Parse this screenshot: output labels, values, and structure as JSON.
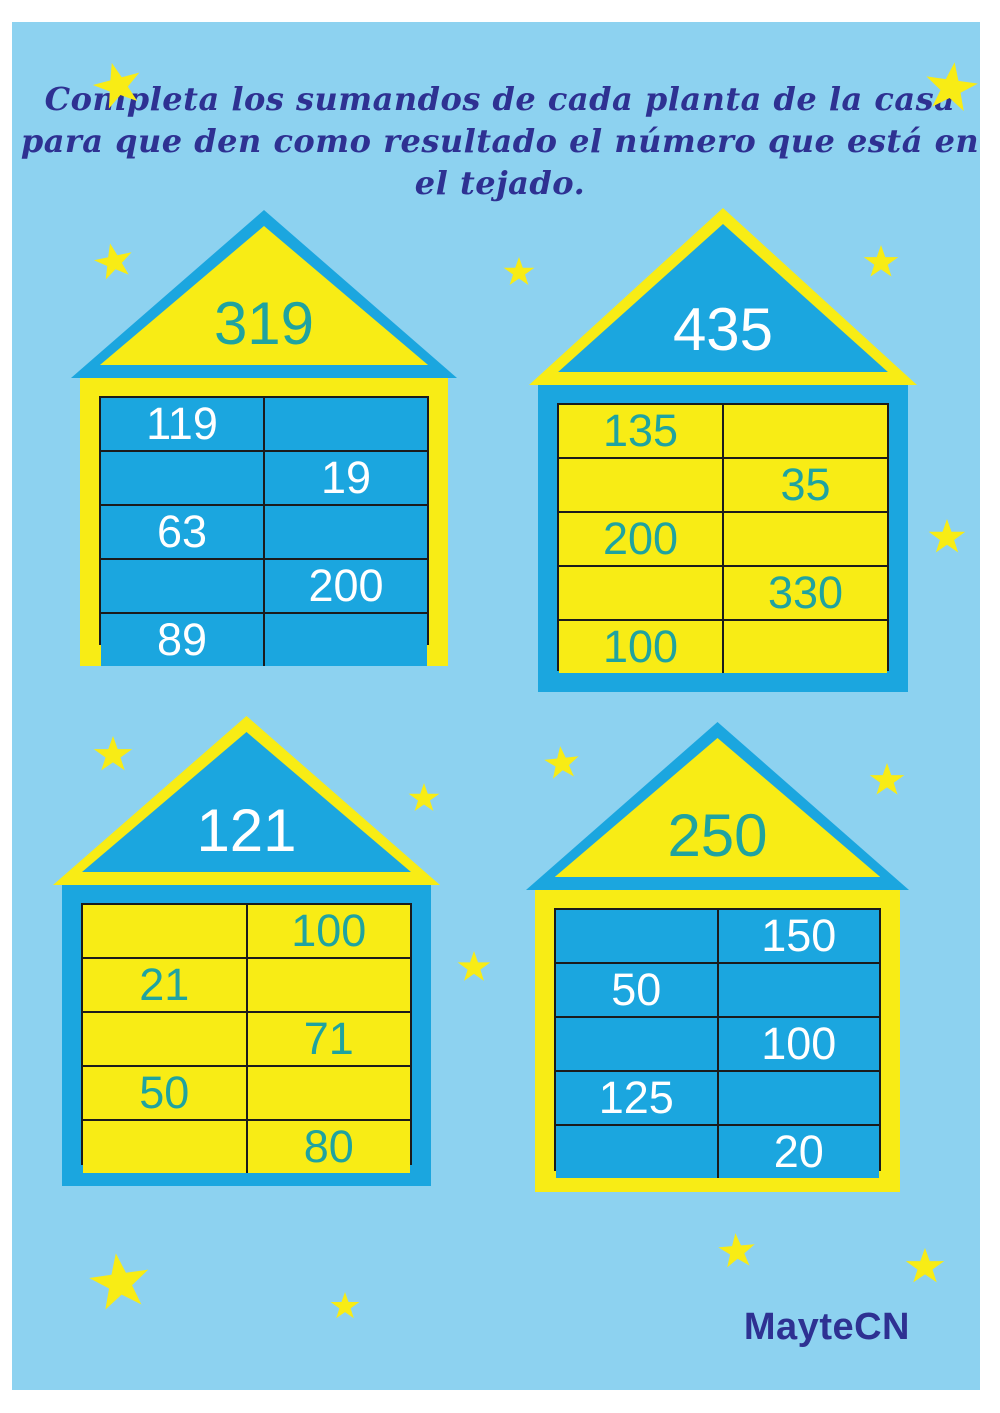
{
  "title": {
    "line1": "Completa los sumandos de cada planta de la casa",
    "line2": "para que den como resultado el número que está en el tejado."
  },
  "credit": "MayteCN",
  "colors": {
    "page_bg": "#8DD2F0",
    "blue": "#1BA6DF",
    "yellow": "#F8EC15",
    "teal_number": "#1FA3A0",
    "white_number": "#FFFFFF",
    "navy_text": "#2E3192",
    "grid_line": "#1b1b1b"
  },
  "houses": [
    {
      "id": "house-319",
      "roof_total": "319",
      "scheme": "yellow-roof",
      "rows": [
        {
          "left": "119",
          "right": ""
        },
        {
          "left": "",
          "right": "19"
        },
        {
          "left": "63",
          "right": ""
        },
        {
          "left": "",
          "right": "200"
        },
        {
          "left": "89",
          "right": ""
        }
      ]
    },
    {
      "id": "house-435",
      "roof_total": "435",
      "scheme": "blue-roof",
      "rows": [
        {
          "left": "135",
          "right": ""
        },
        {
          "left": "",
          "right": "35"
        },
        {
          "left": "200",
          "right": ""
        },
        {
          "left": "",
          "right": "330"
        },
        {
          "left": "100",
          "right": ""
        }
      ]
    },
    {
      "id": "house-121",
      "roof_total": "121",
      "scheme": "blue-roof",
      "rows": [
        {
          "left": "",
          "right": "100"
        },
        {
          "left": "21",
          "right": ""
        },
        {
          "left": "",
          "right": "71"
        },
        {
          "left": "50",
          "right": ""
        },
        {
          "left": "",
          "right": "80"
        }
      ]
    },
    {
      "id": "house-250",
      "roof_total": "250",
      "scheme": "yellow-roof",
      "rows": [
        {
          "left": "",
          "right": "150"
        },
        {
          "left": "50",
          "right": ""
        },
        {
          "left": "",
          "right": "100"
        },
        {
          "left": "125",
          "right": ""
        },
        {
          "left": "",
          "right": "20"
        }
      ]
    }
  ]
}
